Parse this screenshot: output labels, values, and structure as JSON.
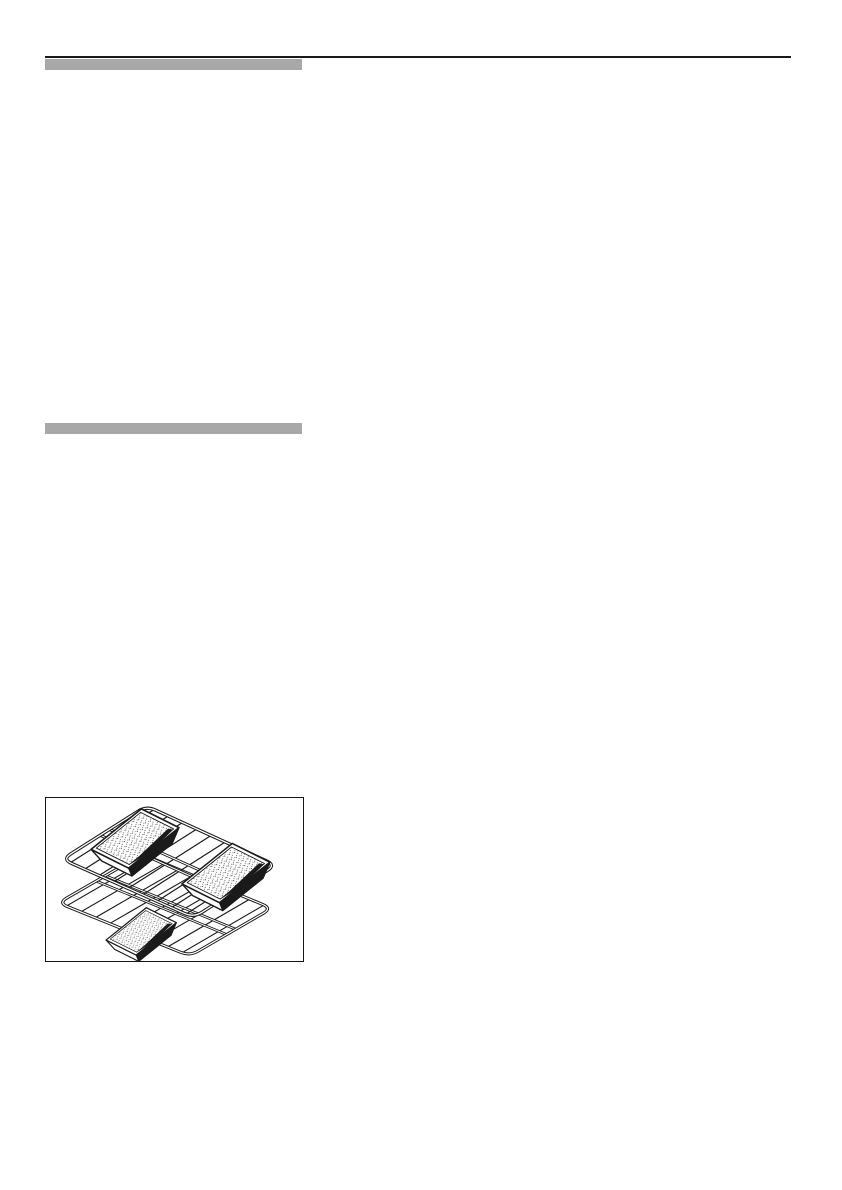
{
  "page": {
    "background_color": "#ffffff"
  },
  "top_rule": {
    "color": "#1a1a1a"
  },
  "heading_bars": {
    "color": "#a8a8a8",
    "count": 2,
    "note": "solid gray placeholder bars with no visible text"
  },
  "figure": {
    "description": "Black-and-white line drawing of two oven wire racks shown in perspective, one above the other, holding three rectangular loaf baking tins with stippled dough surfaces: two tins on the upper rack and one tin on the lower rack",
    "border_color": "#151515",
    "ink_color": "#1a1a1a",
    "background_color": "#ffffff"
  }
}
